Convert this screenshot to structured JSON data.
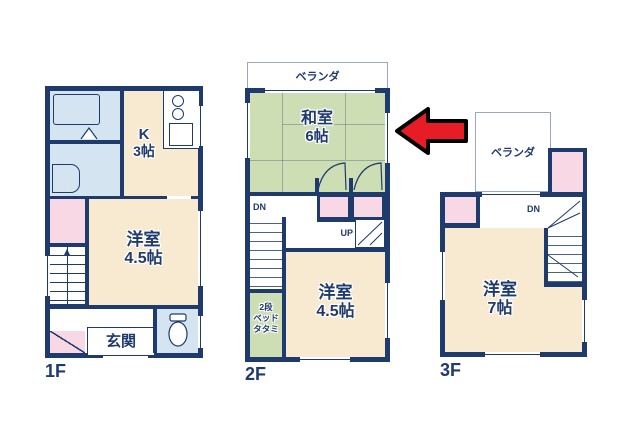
{
  "colors": {
    "wall": "#1f3a6d",
    "room_beige": "#f7ead0",
    "tatami_green": "#cdddb4",
    "closet_pink": "#f8d8e4",
    "bath_blue": "#d4e4f0",
    "arrow_red": "#e81c24"
  },
  "floor1": {
    "floor_label": "1F",
    "kitchen": {
      "line1": "K",
      "line2": "3帖"
    },
    "western_room": {
      "line1": "洋室",
      "line2": "4.5帖"
    },
    "entrance_label": "玄関",
    "stairs_up_label": "UP"
  },
  "floor2": {
    "floor_label": "2F",
    "veranda_label": "ベランダ",
    "japanese_room": {
      "line1": "和室",
      "line2": "6帖"
    },
    "western_room": {
      "line1": "洋室",
      "line2": "4.5帖"
    },
    "bunk_bed": {
      "line1": "2段",
      "line2": "ベッド",
      "line3": "タタミ"
    },
    "stairs_down_label": "DN",
    "stairs_up_label": "UP"
  },
  "floor3": {
    "floor_label": "3F",
    "veranda_label": "ベランダ",
    "western_room": {
      "line1": "洋室",
      "line2": "7帖"
    },
    "stairs_down_label": "DN"
  }
}
